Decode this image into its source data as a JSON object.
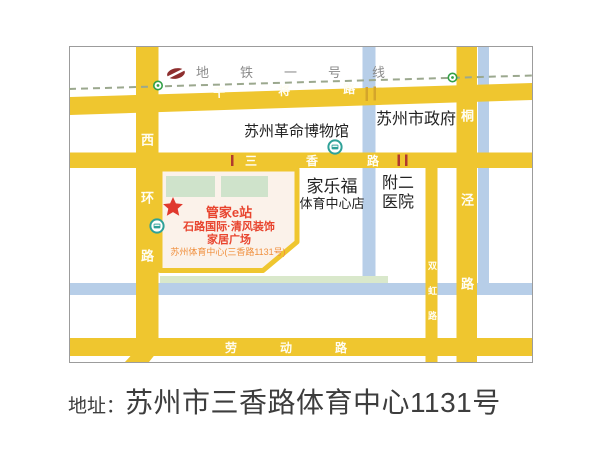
{
  "map": {
    "metro": {
      "line_label": "地铁一号线"
    },
    "roads": {
      "ganjiang": "干将路",
      "sanxiang": "三香路",
      "laodong": "劳动路",
      "xihuan": "西环路",
      "tongjing": "桐泾路",
      "shuanghong": "双虹路"
    },
    "pois": {
      "museum": "苏州革命博物馆",
      "government": "苏州市政府",
      "carrefour_line1": "家乐福",
      "carrefour_line2": "体育中心店",
      "hospital_line1": "附二",
      "hospital_line2": "医院"
    },
    "venue": {
      "name": "管家e站",
      "line1": "石路国际·清风装饰",
      "line2": "家居广场",
      "line3": "苏州体育中心(三香路1131号)"
    }
  },
  "address": {
    "prefix": "地址：",
    "text": "苏州市三香路体育中心1131号"
  },
  "colors": {
    "road_yellow": "#EFC62F",
    "river_blue": "#B7CEE8",
    "metro_dash": "#9BA88E",
    "metro_logo_maroon": "#8E2F2F",
    "station_green": "#33A047",
    "bus_teal": "#2FA198",
    "venue_red": "#E8442E",
    "venue_orange": "#F0903F",
    "block_fill": "#FBF2EA",
    "lawn_green": "#CFE3CB",
    "address_gray": "#3D3D3D"
  }
}
